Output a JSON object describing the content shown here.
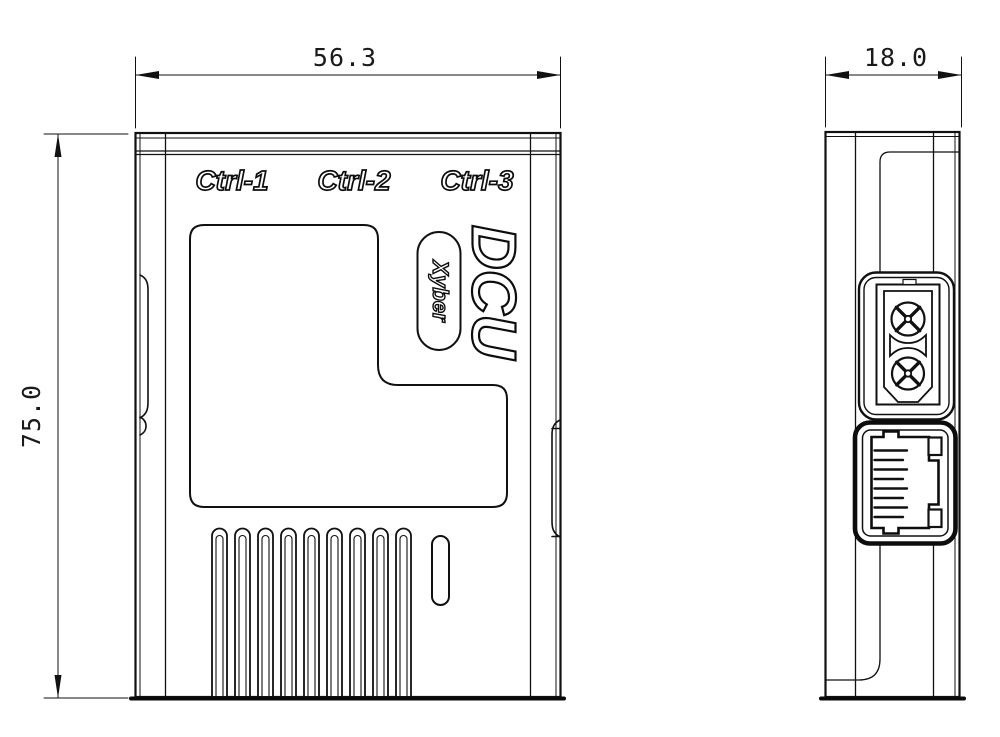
{
  "page": {
    "background": "#ffffff",
    "line_color": "#111111"
  },
  "front_view": {
    "port_labels": [
      "Ctrl-1",
      "Ctrl-2",
      "Ctrl-3"
    ],
    "model_label": "DCU",
    "brand_label": "Xyber",
    "width_dim": "56.3",
    "height_dim": "75.0"
  },
  "side_view": {
    "depth_dim": "18.0"
  }
}
